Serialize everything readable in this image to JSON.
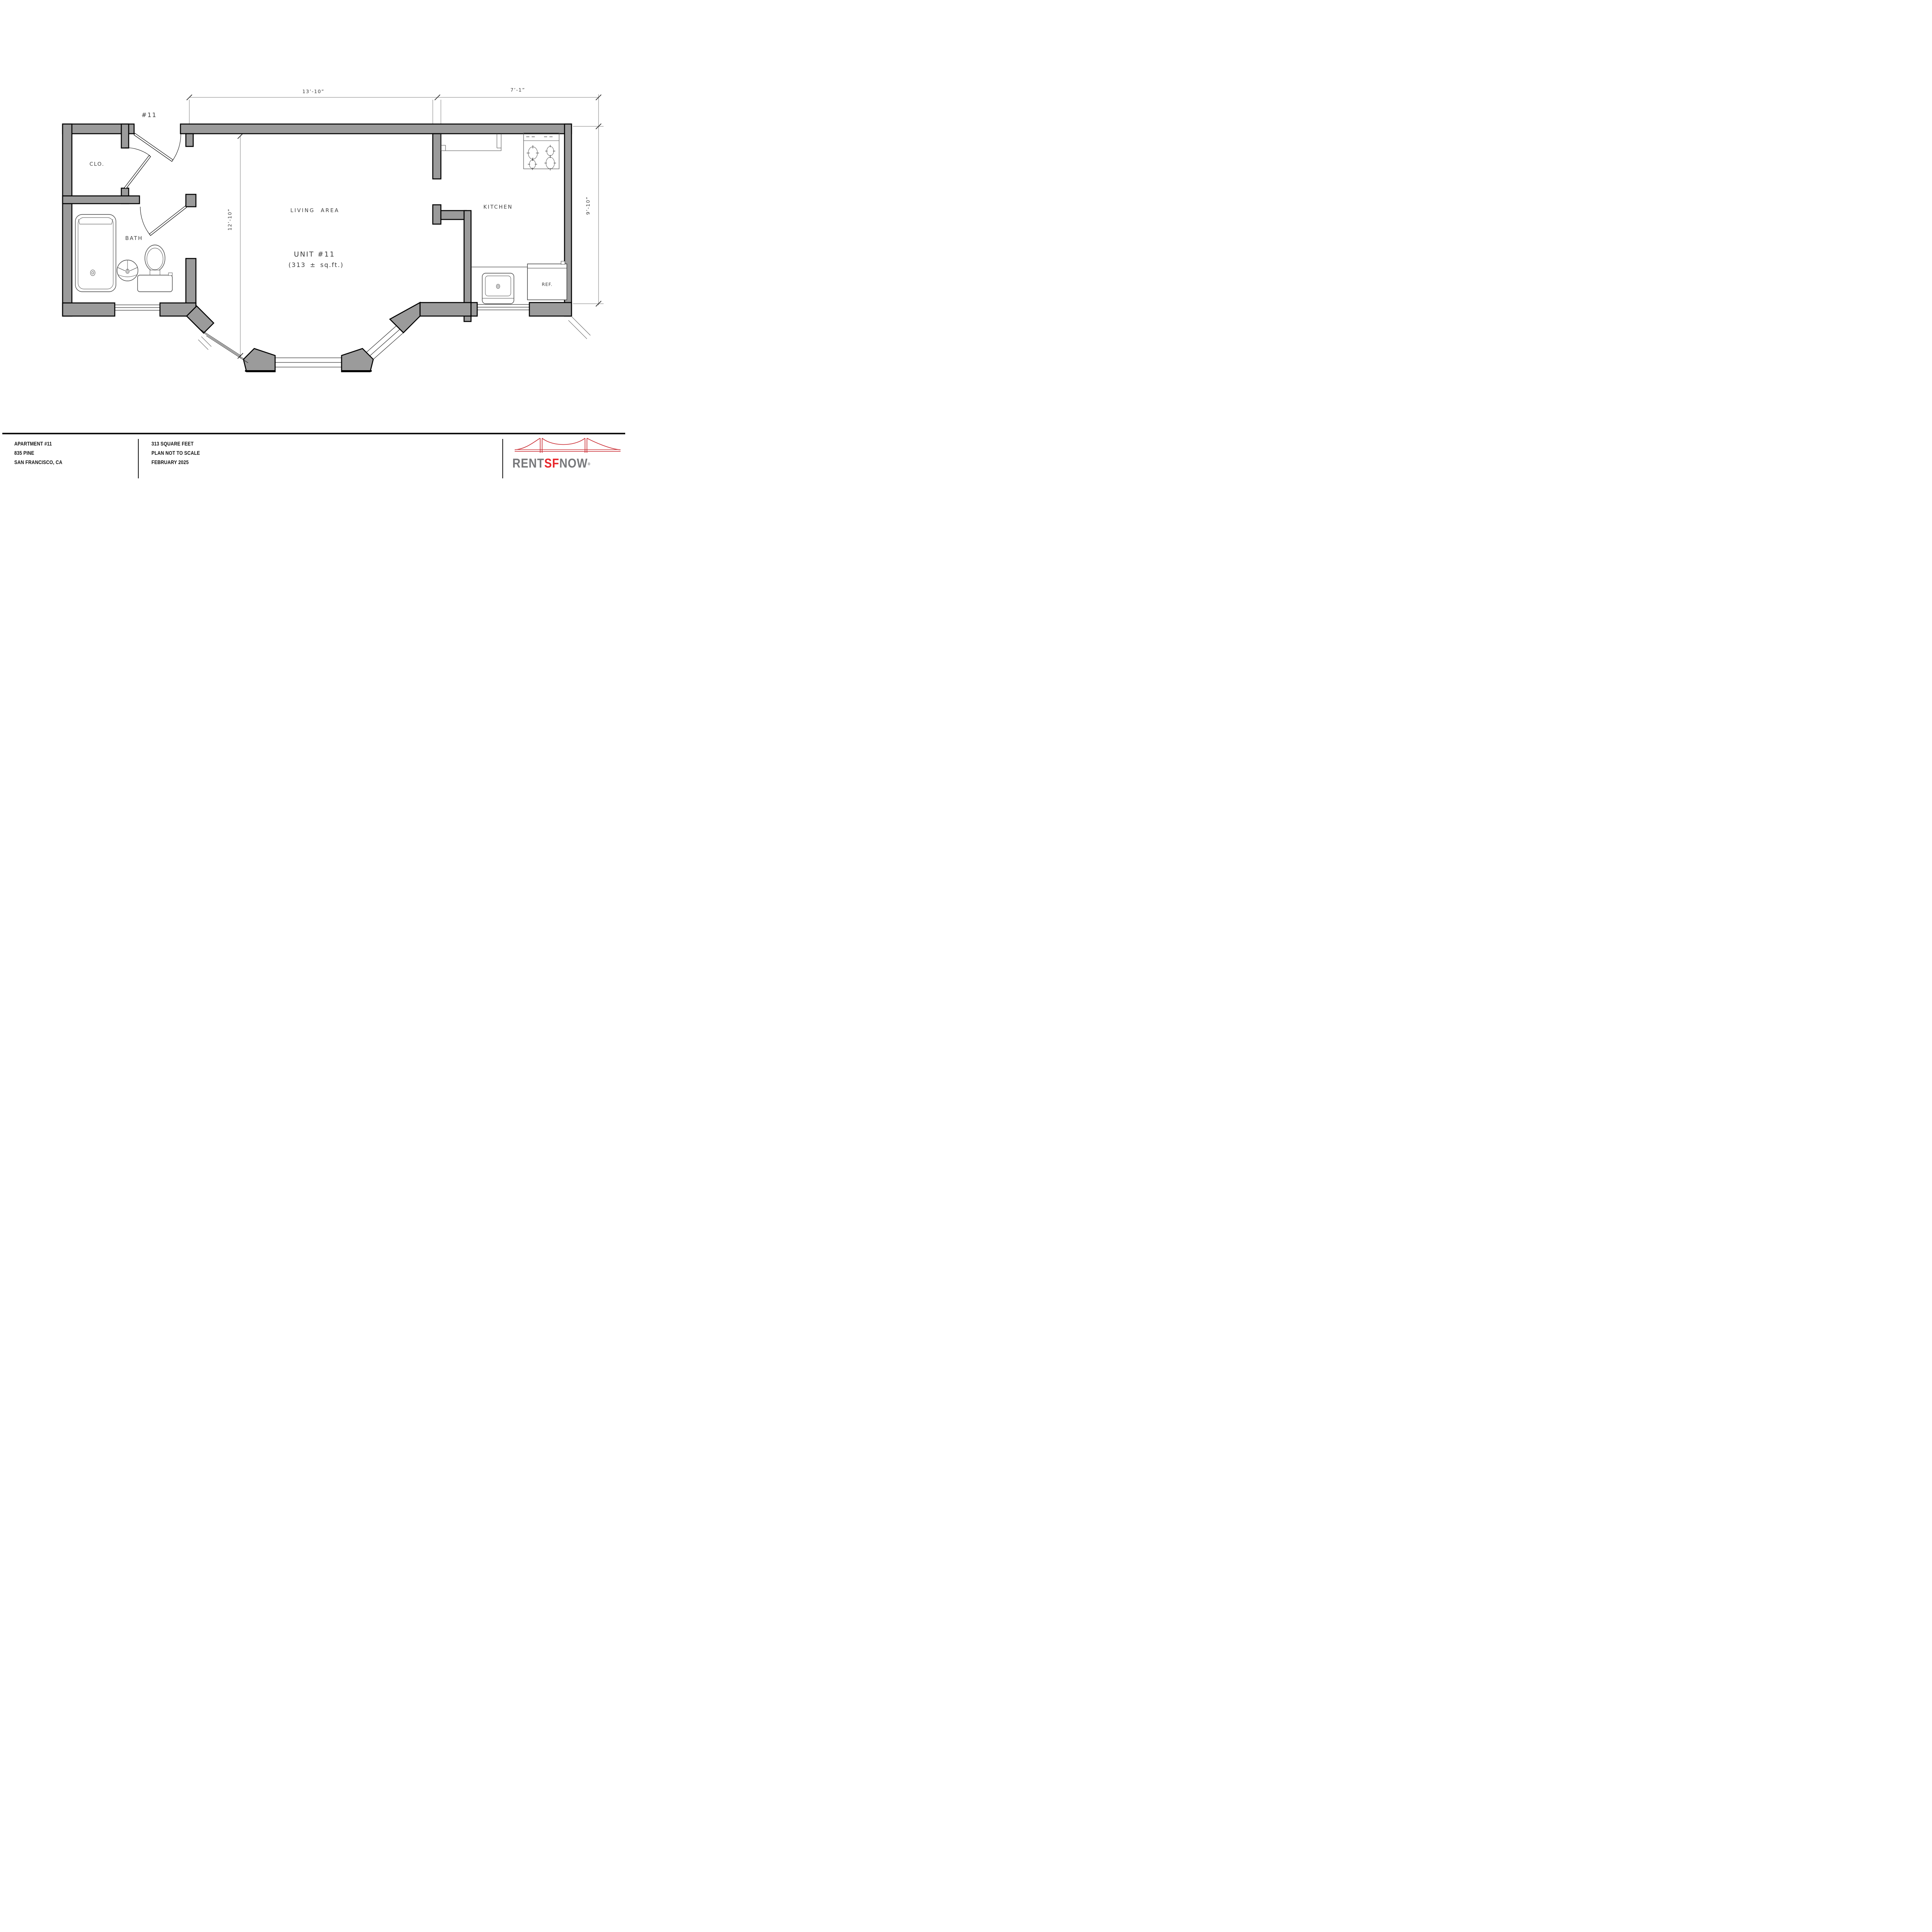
{
  "plan": {
    "entry_label": "#11",
    "rooms": {
      "closet": "CLO.",
      "bath": "BATH",
      "living": "LIVING AREA",
      "kitchen": "KITCHEN",
      "fridge": "REF."
    },
    "unit_title": "UNIT #11",
    "unit_area": "(313 ± sq.ft.)",
    "dimensions": {
      "top_left": "13’-10”",
      "top_right": "7’-1”",
      "living_height": "12’-10”",
      "kitchen_height": "9’-10”"
    }
  },
  "footer": {
    "address": [
      "APARTMENT #11",
      "835 PINE",
      "SAN FRANCISCO, CA"
    ],
    "details": [
      "313 SQUARE FEET",
      "PLAN NOT TO SCALE",
      "FEBRUARY 2025"
    ],
    "logo": {
      "rent": "RENT",
      "sf": "SF",
      "now": "NOW",
      "registered": "®"
    },
    "colors": {
      "bridge_red": "#c8242b",
      "logo_gray": "#77787b",
      "logo_red": "#e8252a"
    }
  }
}
